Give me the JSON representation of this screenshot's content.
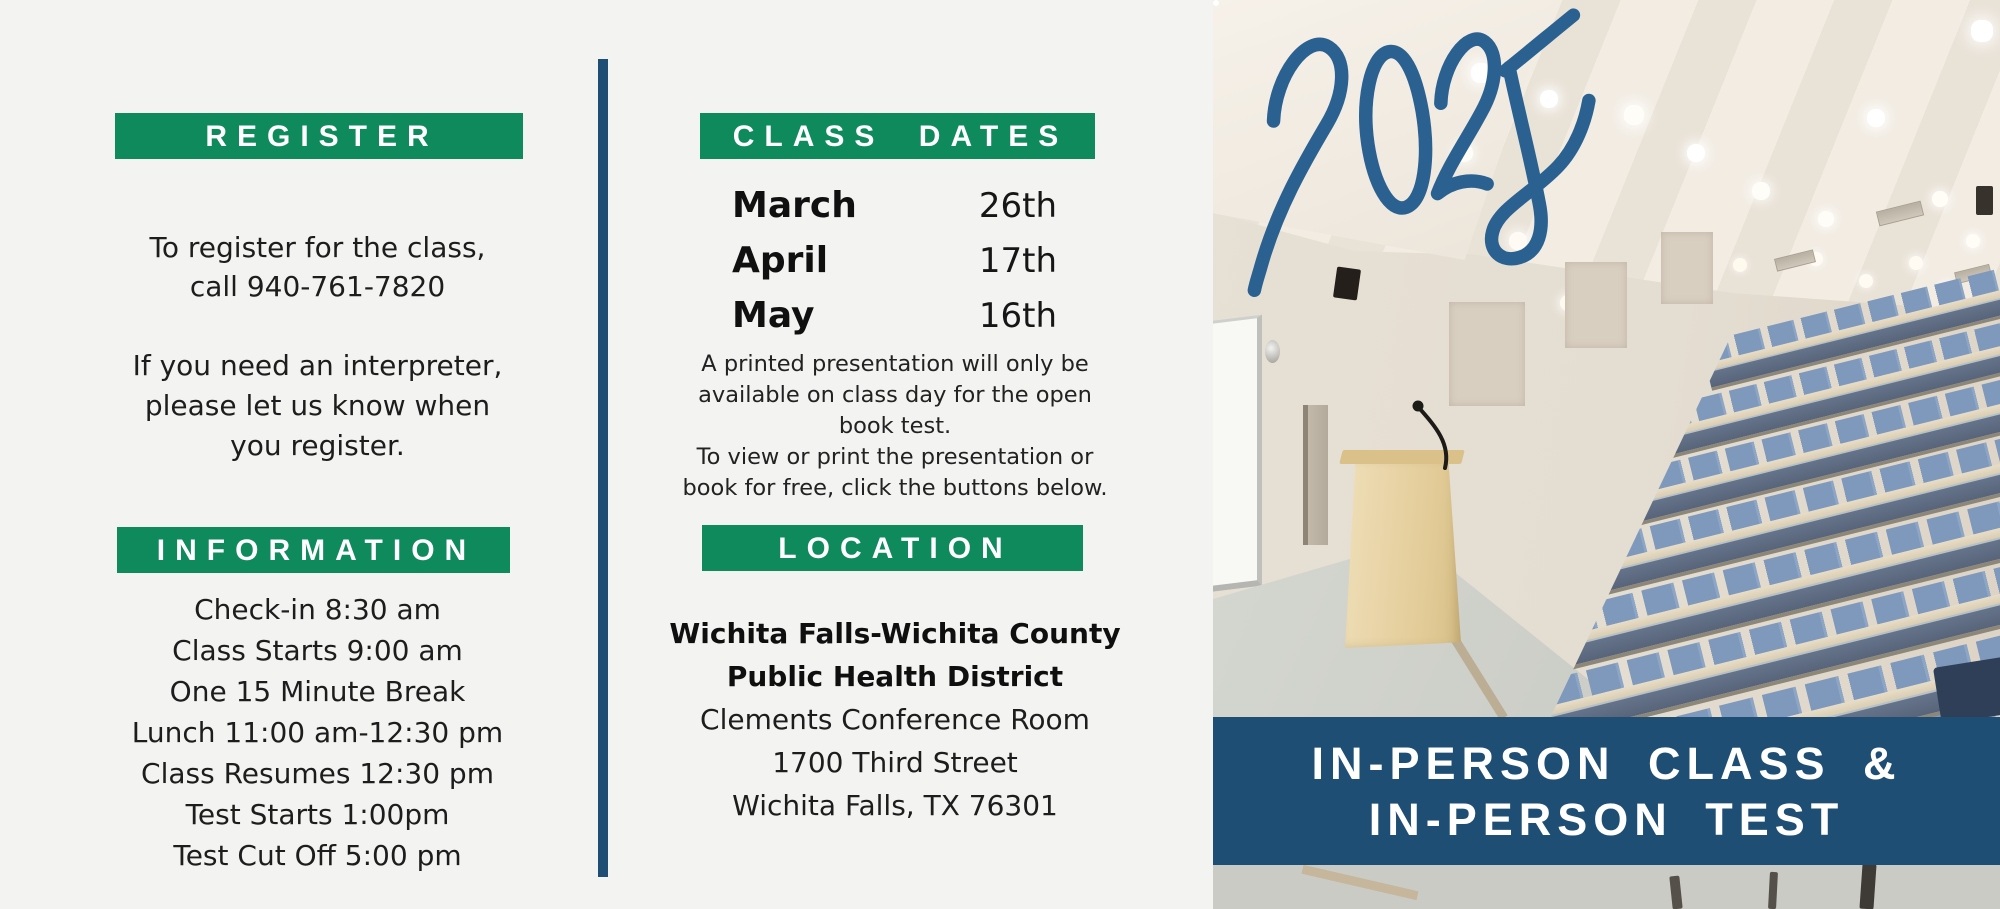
{
  "colors": {
    "green": "#0e8a5d",
    "dark_blue": "#1e4e74",
    "script_blue": "#2b6191",
    "background": "#f3f3f1",
    "text": "#1d1d1d",
    "banner_text": "#ffffff"
  },
  "register": {
    "header": "REGISTER",
    "para1_line1": "To register for the class,",
    "para1_line2": "call 940-761-7820",
    "para2_line1": "If you need an interpreter,",
    "para2_line2": "please let us know when",
    "para2_line3": "you register."
  },
  "information": {
    "header": "INFORMATION",
    "items": [
      "Check-in 8:30 am",
      "Class Starts 9:00 am",
      "One 15 Minute Break",
      "Lunch 11:00 am-12:30 pm",
      "Class Resumes 12:30 pm",
      "Test Starts 1:00pm",
      "Test Cut Off 5:00 pm"
    ]
  },
  "class_dates": {
    "header": "CLASS DATES",
    "rows": [
      {
        "month": "March",
        "day": "26th"
      },
      {
        "month": "April",
        "day": "17th"
      },
      {
        "month": "May",
        "day": "16th"
      }
    ],
    "note_lines": [
      "A printed presentation will only be",
      "available on class day for the open",
      "book test.",
      "To view or print the presentation or",
      "book for free, click the buttons below."
    ]
  },
  "location": {
    "header": "LOCATION",
    "name_line1": "Wichita Falls-Wichita County",
    "name_line2": "Public Health District",
    "lines": [
      "Clements Conference Room",
      "1700 Third Street",
      "Wichita Falls, TX 76301"
    ]
  },
  "photo": {
    "year": "2025",
    "banner_line1": "IN-PERSON CLASS &",
    "banner_line2": "IN-PERSON TEST"
  }
}
